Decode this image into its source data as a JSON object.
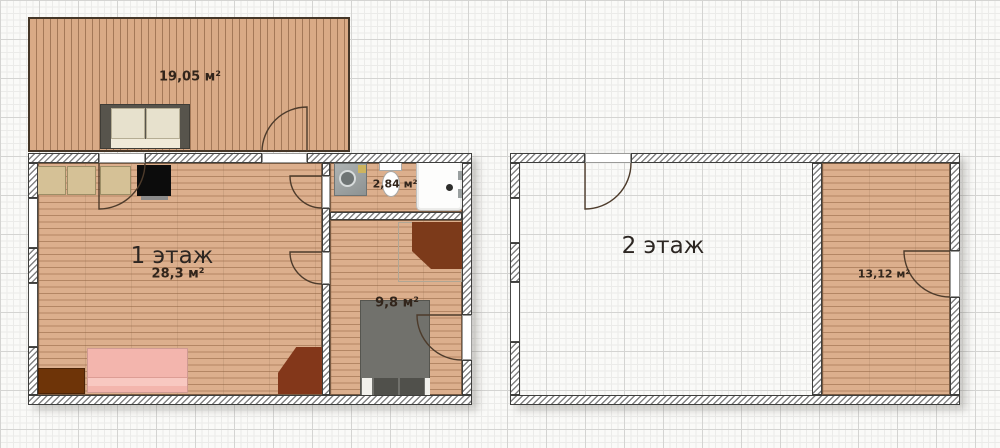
{
  "floorplan": {
    "floor1": {
      "title": "1 этаж",
      "area": "28,3 м²",
      "terrace_area": "19,05 м²",
      "bathroom_area": "2,84 м²",
      "bedroom_area": "9,8 м²"
    },
    "floor2": {
      "title": "2 этаж",
      "room_area": "13,12 м²"
    },
    "colors": {
      "floor_wood": "#dcaf8d",
      "terrace_wood": "#d9aa86",
      "wall_hatch_line": "#828282",
      "wall_outline": "#3e3e3c",
      "sofa_pink": "#f3b5ad",
      "furniture_brown": "#83371a",
      "cabinet_beige": "#d5c196",
      "bed_gray": "#71716c",
      "stove_black": "#0c0c0c",
      "grid_line": "#d4d4d2"
    }
  }
}
